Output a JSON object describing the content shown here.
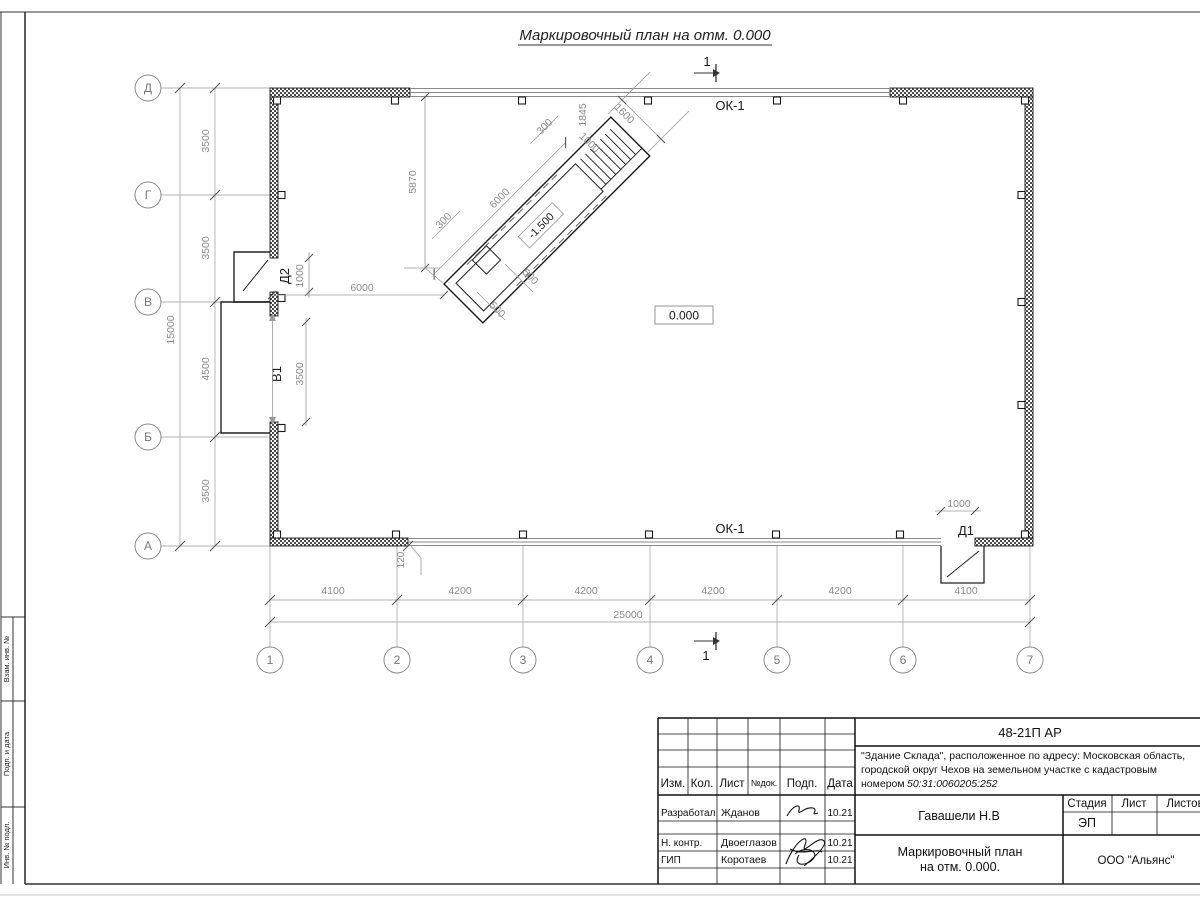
{
  "sheet": {
    "title": "Маркировочный план на отм. 0.000",
    "section_mark": "1",
    "level_mark": "0.000"
  },
  "plan": {
    "window_label_top": "ОК-1",
    "window_label_bottom": "ОК-1",
    "door1_label": "Д1",
    "door2_label": "Д2",
    "opening_label": "В1",
    "axes_rows": [
      "Д",
      "Г",
      "В",
      "Б",
      "А"
    ],
    "axes_cols": [
      "1",
      "2",
      "3",
      "4",
      "5",
      "6",
      "7"
    ],
    "dims_left_segments": [
      "3500",
      "3500",
      "4500",
      "3500"
    ],
    "dim_left_total": "15000",
    "dims_bottom_segments": [
      "4100",
      "4200",
      "4200",
      "4200",
      "4200",
      "4100"
    ],
    "dim_bottom_total": "25000",
    "dim_wall_offset": "120",
    "dim_door2": "1000",
    "dim_opening": "3500",
    "dim_door1": "1000",
    "dim_ramp_to_wall": "6000",
    "ramp": {
      "level": "-1.500",
      "length": "6000",
      "to_axis": "5870",
      "run": "1845",
      "width": "1600",
      "landing": "1000",
      "side_top": "300",
      "side_bottom": "300",
      "pit_a": "500",
      "pit_b": "500"
    }
  },
  "titleblock": {
    "code": "48-21П АР",
    "desc_line1": "\"Здание Склада\", расположенное по адресу: Московская область,",
    "desc_line2": "городской округ Чехов на земельном участке с кадастровым",
    "desc_line3_prefix": "номером",
    "desc_line3_number": "50:31:0060205:252",
    "headers": {
      "izm": "Изм.",
      "kol": "Кол.",
      "list": "Лист",
      "ndok": "№док.",
      "podp": "Подп.",
      "data": "Дата"
    },
    "rows": [
      {
        "role": "Разработал",
        "name": "Жданов",
        "date": "10.21"
      },
      {
        "role": "Н. контр.",
        "name": "Двоеглазов",
        "date": "10.21"
      },
      {
        "role": "ГИП",
        "name": "Коротаев",
        "date": "10.21"
      }
    ],
    "approver": "Гавашели Н.В",
    "stage_label": "Стадия",
    "sheet_label": "Лист",
    "sheets_label": "Листов",
    "stage_value": "ЭП",
    "drawing_title_line1": "Маркировочный план",
    "drawing_title_line2": "на отм. 0.000.",
    "company": "ООО \"Альянс\""
  },
  "frame": {
    "side_labels": [
      "Взам. инв. №",
      "Подп. и дата",
      "Инв. № подл."
    ]
  }
}
